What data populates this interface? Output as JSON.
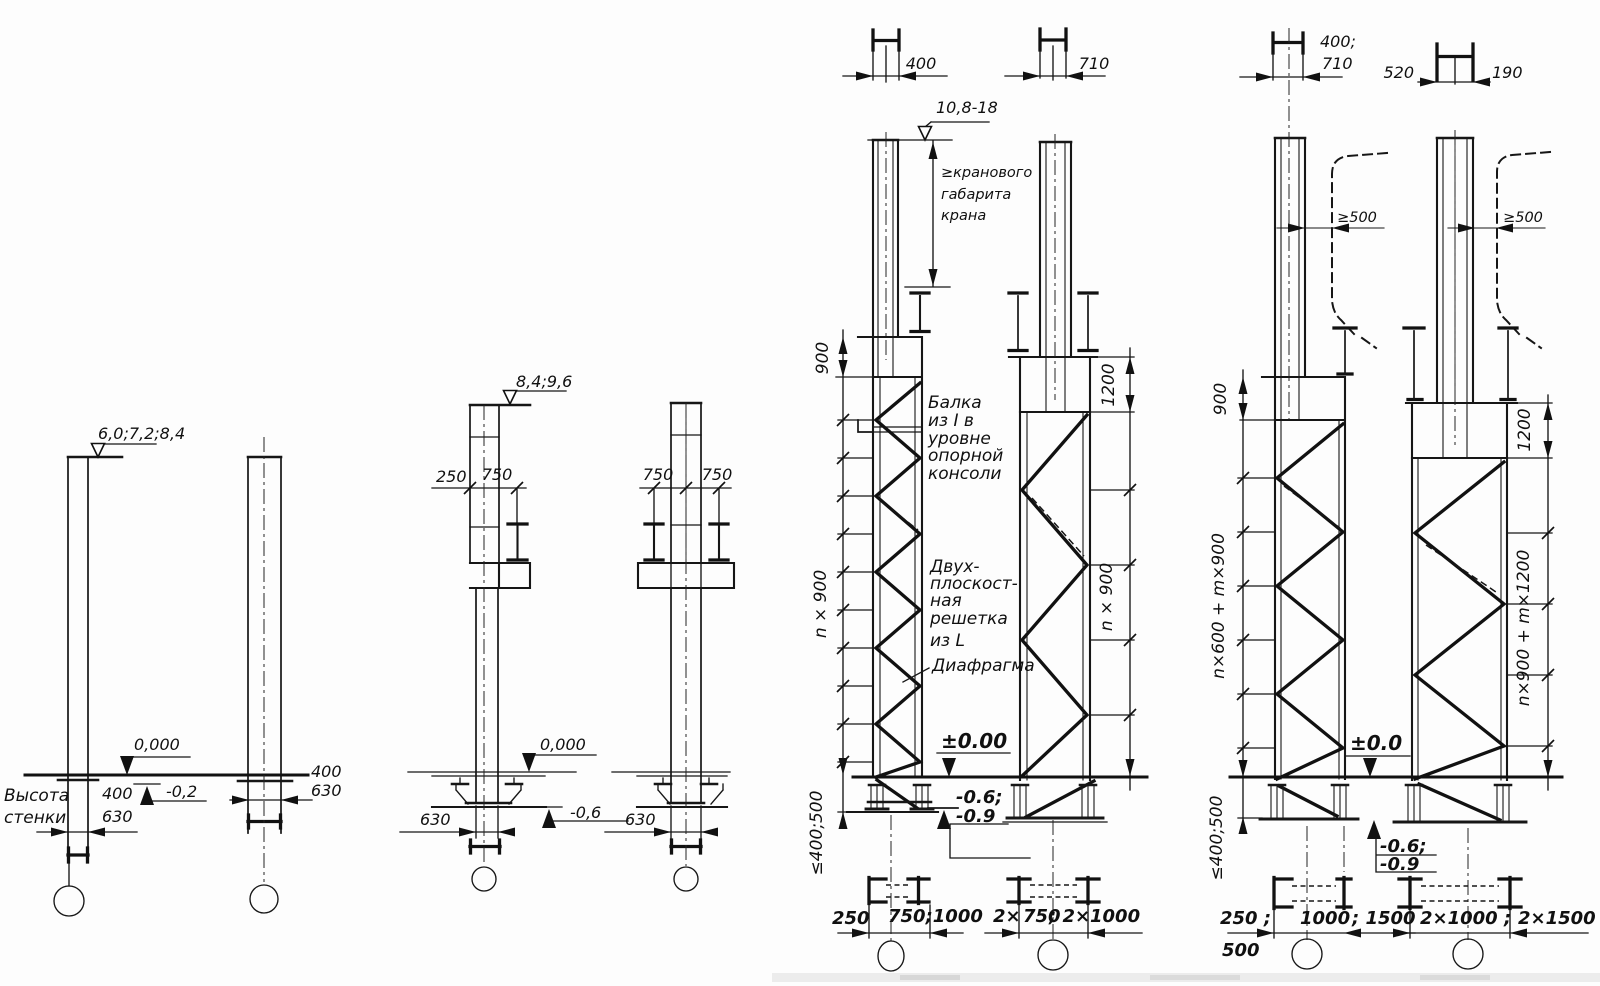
{
  "drawing": {
    "g1": {
      "elevation": "6,0;7,2;8,4",
      "level_zero": "0,000",
      "level_minus": "-0,2",
      "dim_400": "400",
      "dim_630": "630",
      "dim_400_b": "400",
      "dim_630_b": "630",
      "wall_note_1": "Высота",
      "wall_note_2": "стенки"
    },
    "g2": {
      "elevation": "8,4;9,6",
      "dim_250": "250",
      "dim_750": "750",
      "dim_750_b1": "750",
      "dim_750_b2": "750",
      "level_zero": "0,000",
      "level_minus": "-0,6",
      "dim_630_a": "630",
      "dim_630_b": "630"
    },
    "g3": {
      "dim_400": "400",
      "dim_710": "710",
      "elevation": "10,8-18",
      "crane_note_1": "≥кранового",
      "crane_note_2": "габарита",
      "crane_note_3": "крана",
      "dim_900": "900",
      "dim_n900_a": "n × 900",
      "dim_1200": "1200",
      "dim_n900_b": "n × 900",
      "beam_note_1": "Балка",
      "beam_note_2": "из I в",
      "beam_note_3": "уровне",
      "beam_note_4": "опорной",
      "beam_note_5": "консоли",
      "lattice_note_1": "Двух-",
      "lattice_note_2": "плоскост-",
      "lattice_note_3": "ная",
      "lattice_note_4": "решетка",
      "lattice_note_5": "из L",
      "diaphragm_note": "Диафрагма",
      "level_zero": "±0.00",
      "level_minus_1": "-0.6;",
      "level_minus_2": "-0.9",
      "embed_depth": "≤400;500",
      "base_dim_250": "250",
      "base_dim_750_1000": "750;1000",
      "base_dim_2x": "2×",
      "base_dim_750": "750",
      "base_dim_2x_2": "; 2×",
      "base_dim_1000": "1000"
    },
    "g4": {
      "dim_400_710_1": "400;",
      "dim_400_710_2": "710",
      "dim_520": "520",
      "dim_190": "190",
      "clearance_a": "≥500",
      "clearance_b": "≥500",
      "dim_900": "900",
      "dim_chain_a": "n×600 + m×900",
      "dim_1200": "1200",
      "dim_chain_b": "n×900 + m×1200",
      "embed_depth": "≤400;500",
      "level_zero": "±0.0",
      "level_minus_1": "-0.6;",
      "level_minus_2": "-0.9",
      "base_dim_250": "250 ;",
      "base_dim_500": "500",
      "base_dim_1000": "1000",
      "base_dim_1500": "; 1500",
      "base_dim_2x1000": "2×1000 ;",
      "base_dim_2x1500": "2×1500"
    }
  }
}
